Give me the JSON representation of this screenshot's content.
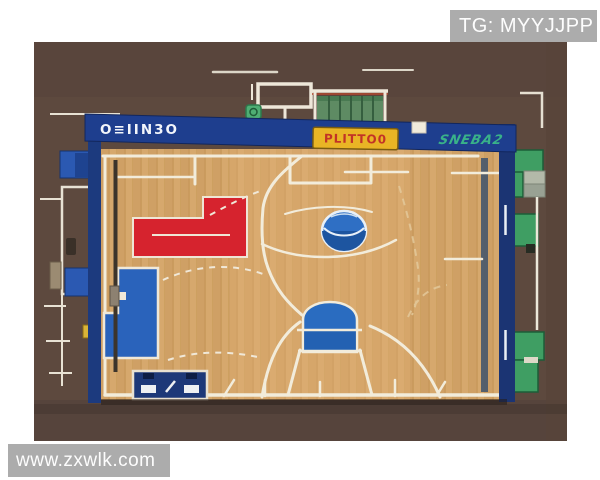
{
  "watermarks": {
    "top_right": "TG: MYYJJPP",
    "bottom_left": "www.zxwlk.com"
  },
  "scoreboard_banner": {
    "left_text": "O≡IIN3O",
    "center_sign_text": "PLITTO0",
    "right_text": "SNEBA2"
  },
  "colors": {
    "background_brown": "#5d493e",
    "court_wood": "#d6a76c",
    "banner_navy": "#1e3e8e",
    "paint_red": "#d6232e",
    "paint_blue": "#2a63bb",
    "bottom_key_blue": "#2a6cc0",
    "center_ball_blue": "#2f6fc4",
    "sign_yellow": "#e9b525",
    "sign_text_red": "#c23326",
    "graffiti_green": "#39b289",
    "bench_green": "#3f9e63",
    "line_cream": "#f2ecdb",
    "watermark_gray": "#a9a9a9"
  }
}
